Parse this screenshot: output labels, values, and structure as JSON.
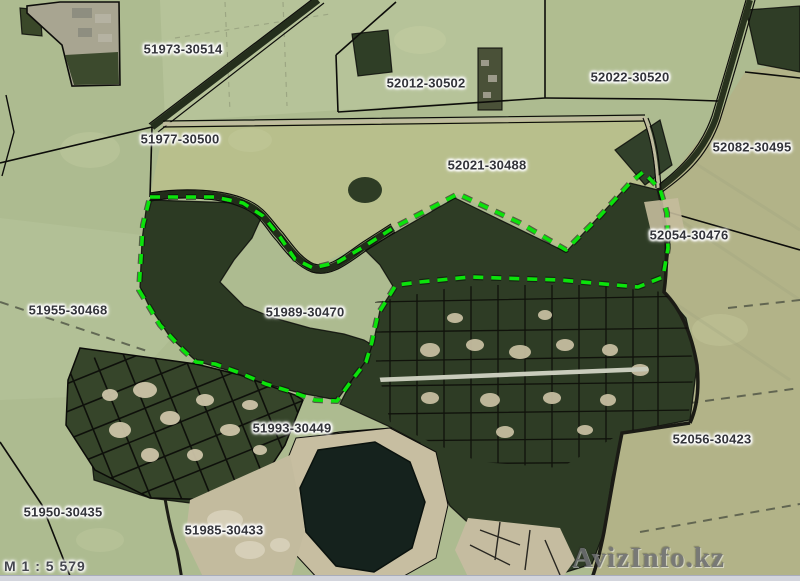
{
  "map": {
    "scale_label": "M 1 : 5 579",
    "watermark": "AvizInfo.kz",
    "parcels": [
      {
        "code": "51973-30514"
      },
      {
        "code": "51977-30500"
      },
      {
        "code": "52012-30502"
      },
      {
        "code": "52022-30520"
      },
      {
        "code": "52021-30488"
      },
      {
        "code": "52082-30495"
      },
      {
        "code": "52054-30476"
      },
      {
        "code": "51955-30468"
      },
      {
        "code": "51989-30470"
      },
      {
        "code": "51993-30449"
      },
      {
        "code": "52056-30423"
      },
      {
        "code": "51950-30435"
      },
      {
        "code": "51985-30433"
      }
    ],
    "highlighted_parcel": {
      "code": "51989-30470"
    },
    "colors": {
      "field": "#adbb90",
      "field_light": "#b6c399",
      "field_yellow": "#b8bf8c",
      "field_olive": "#b2b388",
      "forest": "#2c3a23",
      "forest_dark": "#27331f",
      "water": "#15221d",
      "sand": "#c7bea1",
      "road_tan": "#bfbb9e",
      "cadastral_line": "#0d0d0a",
      "boundary_green": "#0be30b",
      "label_text": "#33343a",
      "watermark_gray": "#6e6f73",
      "bottom_bar": "#d3d5dd"
    }
  }
}
